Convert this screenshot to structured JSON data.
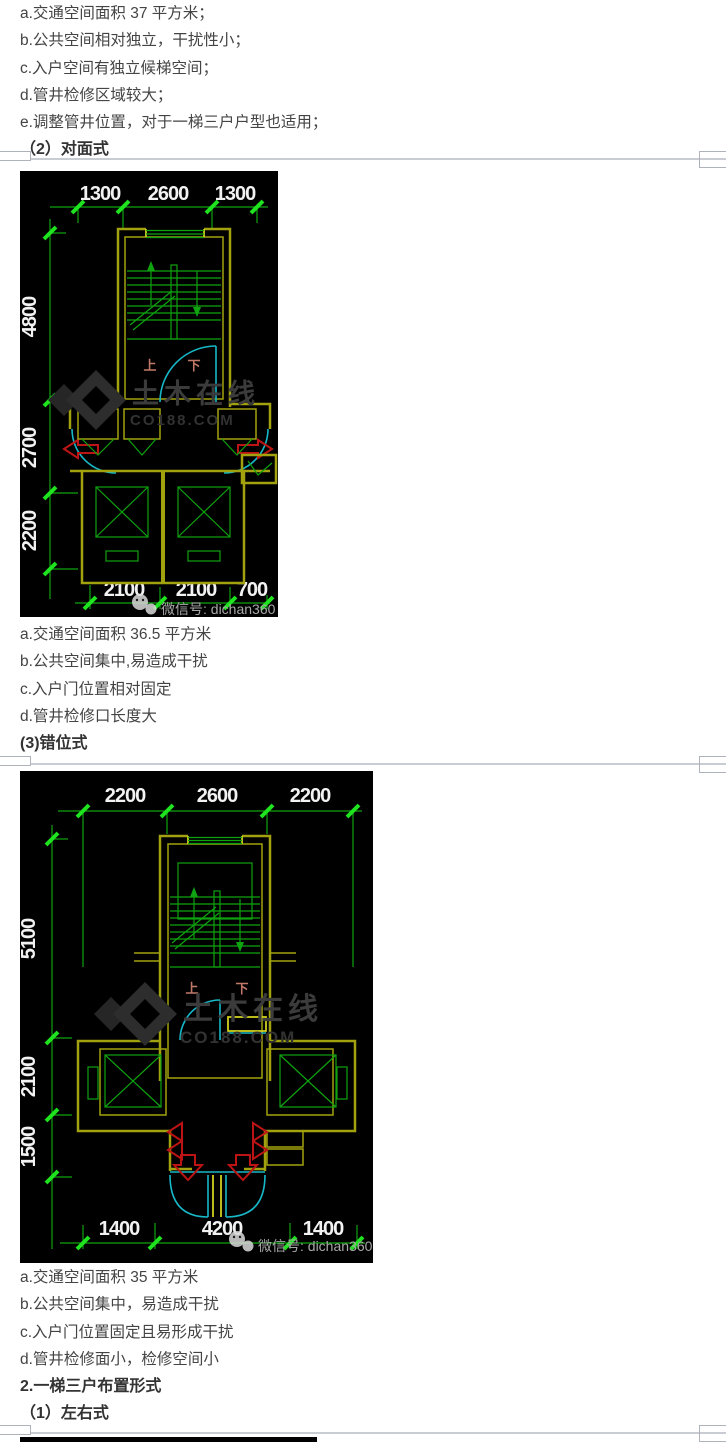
{
  "article": {
    "section_duimianshi": {
      "notes": [
        "a.交通空间面积 37 平方米；",
        "b.公共空间相对独立，干扰性小；",
        "c.入户空间有独立候梯空间；",
        "d.管井检修区域较大；",
        "e.调整管井位置，对于一梯三户户型也适用；"
      ],
      "heading": "（2）对面式"
    },
    "section_cuoweishi": {
      "notes": [
        "a.交通空间面积 36.5 平方米",
        "b.公共空间集中,易造成干扰",
        "c.入户门位置相对固定",
        "d.管井检修口长度大"
      ],
      "heading": "(3)错位式"
    },
    "section_yitisanhu": {
      "notes": [
        "a.交通空间面积 35 平方米",
        "b.公共空间集中，易造成干扰",
        "c.入户门位置固定且易形成干扰",
        "d.管井检修面小，检修空间小"
      ],
      "heading": "2.一梯三户布置形式",
      "subheading": "（1）左右式"
    }
  },
  "figure_duimianshi": {
    "dims_top": [
      "1300",
      "2600",
      "1300"
    ],
    "dims_left": [
      "4800",
      "2700",
      "2200"
    ],
    "dims_bottom": [
      "2100",
      "2100",
      "700"
    ],
    "stair_up_label": "上",
    "stair_down_label": "下",
    "watermark_brand": "土木在线",
    "watermark_site": "CO188.COM",
    "watermark_wechat": "微信号: dichan360"
  },
  "figure_cuoweishi": {
    "dims_top": [
      "2200",
      "2600",
      "2200"
    ],
    "dims_left": [
      "5100",
      "2100",
      "1500"
    ],
    "dims_bottom": [
      "1400",
      "4200",
      "1400"
    ],
    "stair_up_label": "上",
    "stair_down_label": "下",
    "watermark_brand": "土木在线",
    "watermark_site": "CO188.COM",
    "watermark_wechat": "微信号: dichan360"
  },
  "colors": {
    "page_text": "#444444",
    "divider_line": "#c9cdd3",
    "cad_background": "#000000",
    "cad_wall_olive": "#a2a20e",
    "cad_green": "#0fa30f",
    "cad_tick_green": "#1fe31f",
    "cad_cyan": "#17b8c8",
    "cad_red": "#bc1414",
    "cad_dim_text": "#f2f2f2",
    "cad_updown_text": "#c07868",
    "watermark_grey": "#3b3b3b",
    "wechat_text_grey": "#a8a8a8"
  }
}
